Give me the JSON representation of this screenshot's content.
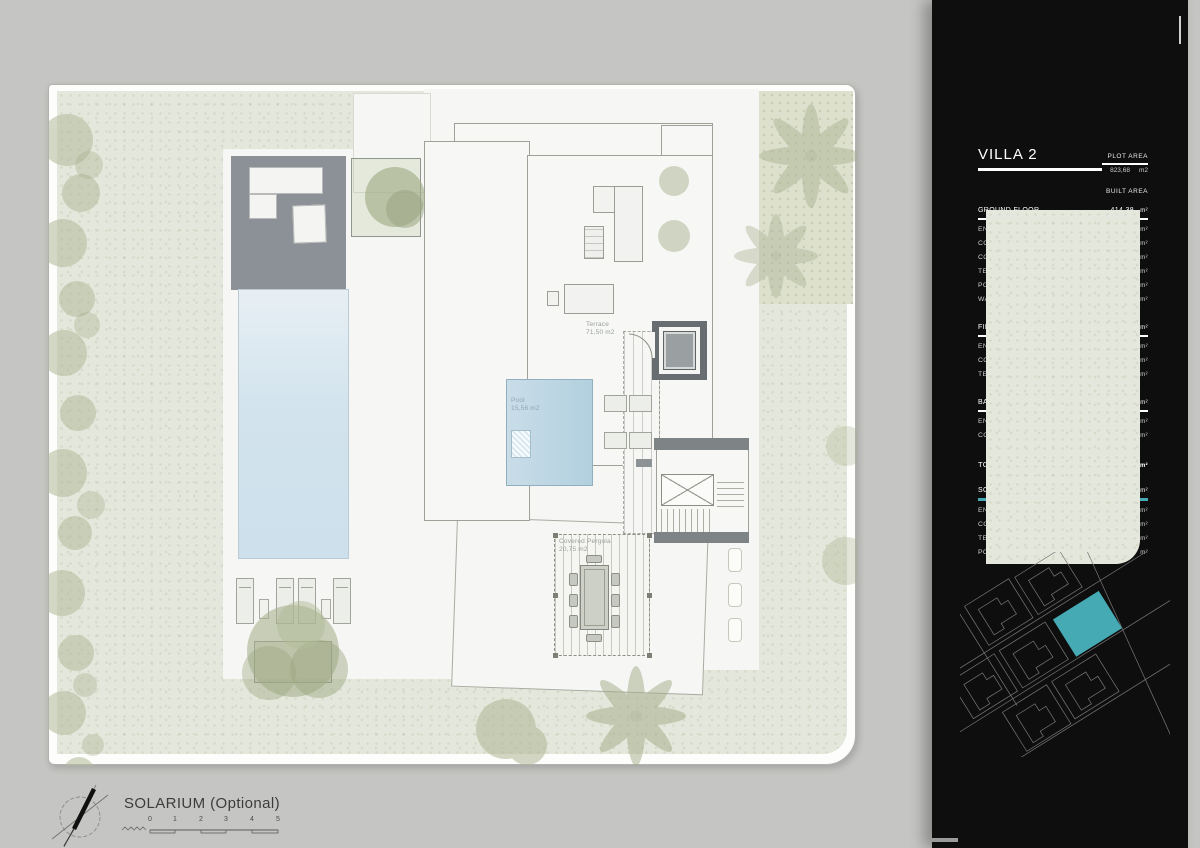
{
  "colors": {
    "accent": "#45aab4",
    "panel_bg": "#0f0e0e",
    "garden_green": "#e4e7db",
    "pool_blue": "#cfe2eb",
    "deck_gray": "#8b9196"
  },
  "plan": {
    "labels": {
      "terrace": {
        "title": "Terrace",
        "area": "71,50 m2"
      },
      "pool": {
        "title": "Pool",
        "area": "15,56 m2"
      },
      "pergola": {
        "title": "Covered Pergola",
        "area": "20,75 m2"
      }
    }
  },
  "sidebar": {
    "title": "VILLA 2",
    "plot_area_label": "PLOT AREA",
    "plot_area_value": "823,68",
    "plot_area_unit": "m2",
    "built_area_label": "BUILT AREA",
    "unit": "m²",
    "sections": [
      {
        "title": "GROUND FLOOR",
        "total": "414,38",
        "rows": [
          {
            "label": "ENCLOSED AREA",
            "value": "113,31"
          },
          {
            "label": "COVERED AREA",
            "value": "94,65"
          },
          {
            "label": "COVERED GARAGE",
            "value": "34,06"
          },
          {
            "label": "TERRACES",
            "value": "74,14"
          },
          {
            "label": "POOL",
            "value": "56,41"
          },
          {
            "label": "WALK AND CAR ACCESS",
            "value": "41,81"
          }
        ]
      },
      {
        "title": "FIRST FLOOR",
        "total": "177,14",
        "rows": [
          {
            "label": "ENCLOSED AREA",
            "value": "118,09"
          },
          {
            "label": "COVERED AREA",
            "value": "37,11"
          },
          {
            "label": "TERRACES",
            "value": "21,94"
          }
        ]
      },
      {
        "title": "BASEMENT",
        "total": "182,56",
        "rows": [
          {
            "label": "ENCLOSED AREA",
            "value": "165,19"
          },
          {
            "label": "COURTYARD",
            "value": "17,37"
          }
        ]
      },
      {
        "title": "SOLARIUM (OPTIONAL)",
        "total": "139,85",
        "rows": [
          {
            "label": "ENCLOSED AREA",
            "value": "4,08"
          },
          {
            "label": "COVERED AREA",
            "value": "37,37"
          },
          {
            "label": "TERRACES",
            "value": "82,84"
          },
          {
            "label": "POOL",
            "value": "15,56"
          }
        ]
      }
    ],
    "totals": {
      "total_label": "TOTAL",
      "total_value": "774,08",
      "garden_label": "GARDEN",
      "garden_value": "409,3"
    }
  },
  "footer": {
    "title": "SOLARIUM (Optional)",
    "scale_ticks": [
      "0",
      "1",
      "2",
      "3",
      "4",
      "5"
    ]
  }
}
